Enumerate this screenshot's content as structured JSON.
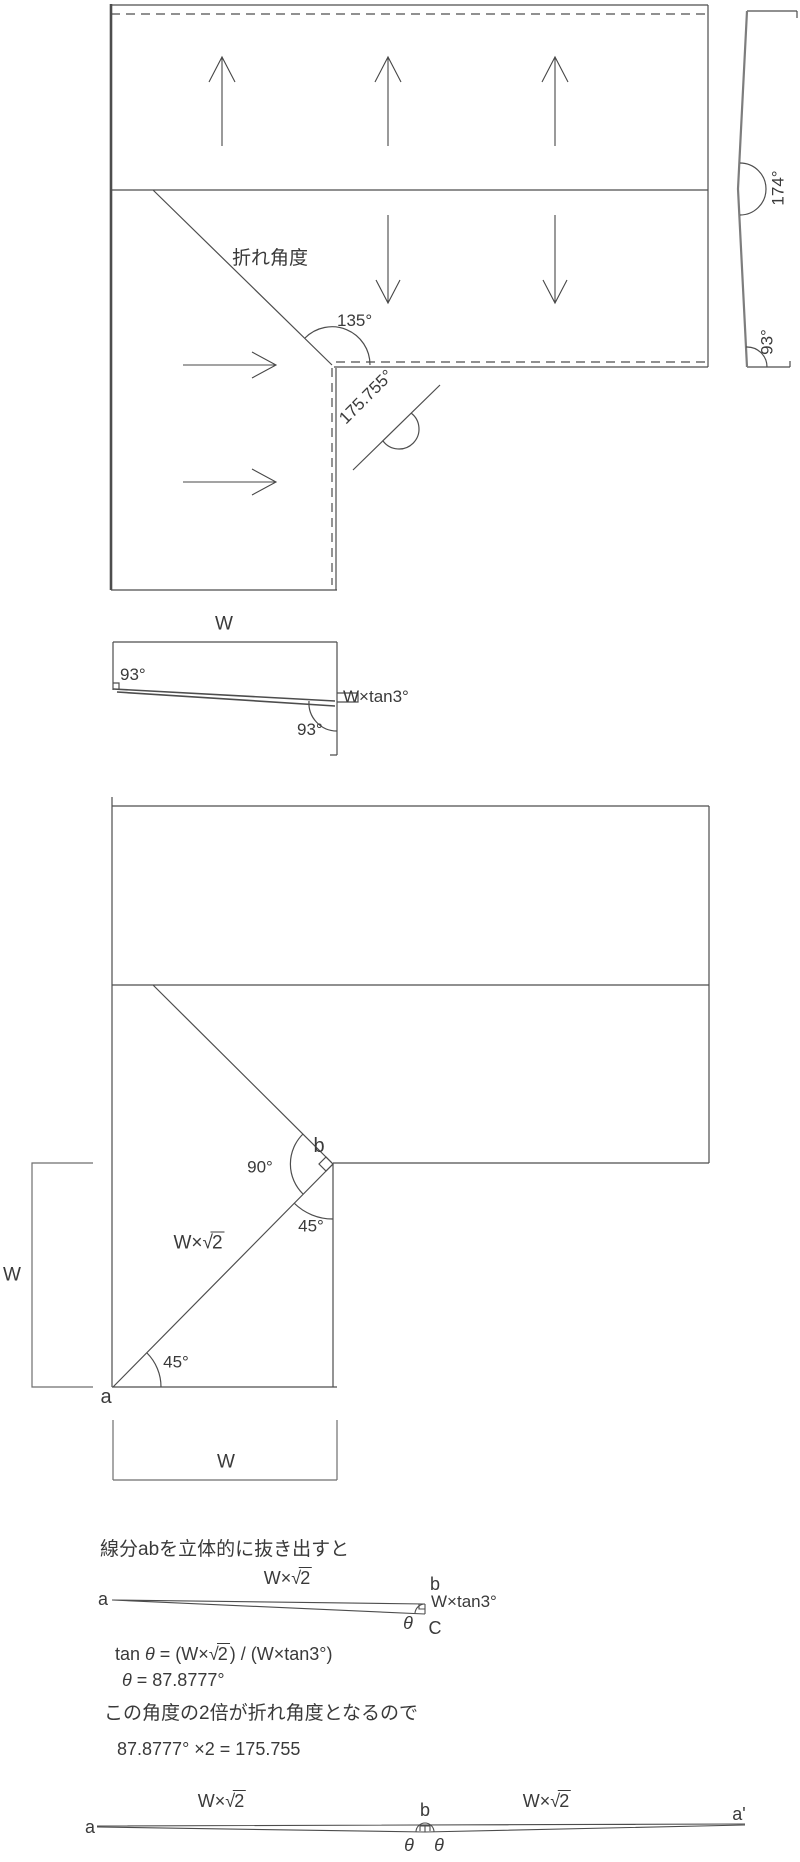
{
  "colors": {
    "line": "#4d4d4d",
    "gray_line": "#7d7d7d",
    "text": "#3a3a3a",
    "bg": "#ffffff"
  },
  "sqrt2": {
    "prefix": "W×",
    "sym": "√",
    "rad": "2"
  },
  "top": {
    "fold_label": "折れ角度",
    "angle_135": "135°",
    "angle_fold": "175.755°",
    "side": {
      "angle_174": "174°",
      "angle_93": "93°"
    }
  },
  "width_diag": {
    "w": "W",
    "angle_left": "93°",
    "angle_right": "93°",
    "offset": "W×tan3°"
  },
  "unfold": {
    "a": "a",
    "b": "b",
    "angle_90": "90°",
    "angle_45_top": "45°",
    "angle_45_bottom": "45°",
    "w_left": "W",
    "w_bottom": "W"
  },
  "extract": {
    "heading": "線分abを立体的に抜き出すと",
    "a": "a",
    "b": "b",
    "c": "C",
    "theta": "θ",
    "offset": "W×tan3°",
    "tan_formula": {
      "p1": "tan ",
      "theta": "θ",
      "p2": " = (W×",
      "sym": "√",
      "rad": "2",
      "p3": ") / (W×tan3°)"
    },
    "theta_formula": {
      "theta": "θ",
      "rest": " = 87.8777°"
    },
    "conclusion": "この角度の2倍が折れ角度となるので",
    "result": "87.8777° ×2 = 175.755"
  },
  "mirror": {
    "a": "a",
    "b": "b",
    "a_prime": "a'",
    "theta_left": "θ",
    "theta_right": "θ"
  }
}
